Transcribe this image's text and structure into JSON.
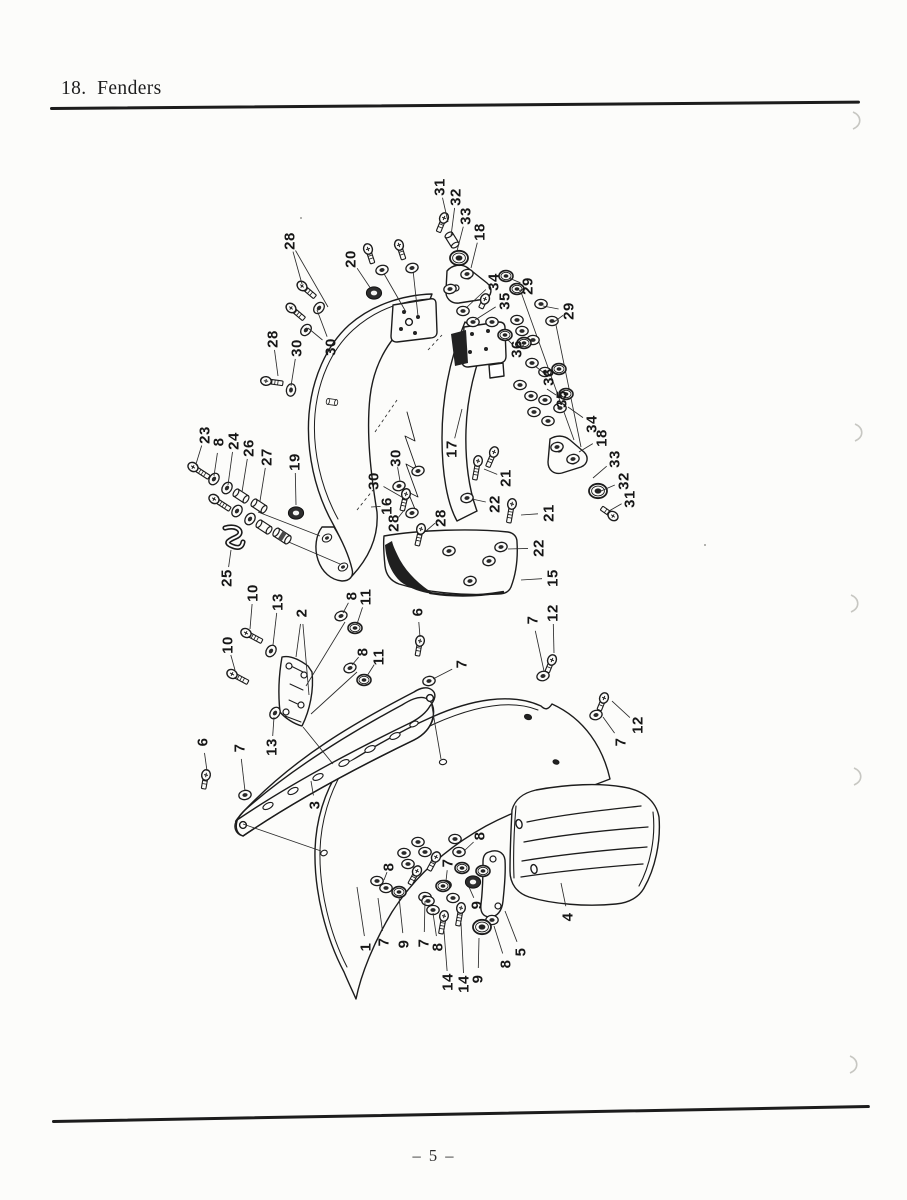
{
  "page": {
    "title": "18.  Fenders",
    "page_number": "– 5 –"
  },
  "diagram": {
    "description": "Exploded parts diagram: front and rear motorcycle fenders with numbered hardware callouts",
    "labels": [
      {
        "n": "31",
        "x": 440,
        "y": 187,
        "t": [
          448,
          222
        ]
      },
      {
        "n": "32",
        "x": 456,
        "y": 197,
        "t": [
          451,
          236
        ]
      },
      {
        "n": "33",
        "x": 466,
        "y": 216,
        "t": [
          457,
          251
        ]
      },
      {
        "n": "18",
        "x": 480,
        "y": 232,
        "t": [
          471,
          268
        ]
      },
      {
        "n": "34",
        "x": 494,
        "y": 282,
        "t": [
          466,
          308
        ]
      },
      {
        "n": "35",
        "x": 505,
        "y": 301,
        "t": [
          475,
          320
        ]
      },
      {
        "n": "29",
        "x": 528,
        "y": 286,
        "t": [
          509,
          278
        ],
        "t2": [
          519,
          291
        ]
      },
      {
        "n": "29",
        "x": 569,
        "y": 311,
        "t": [
          543,
          306
        ],
        "t2": [
          554,
          322
        ]
      },
      {
        "n": "36",
        "x": 517,
        "y": 349,
        "t": [
          506,
          338
        ],
        "t2": [
          524,
          345
        ]
      },
      {
        "n": "36",
        "x": 549,
        "y": 377,
        "t": [
          535,
          366
        ]
      },
      {
        "n": "35",
        "x": 562,
        "y": 399,
        "t": [
          547,
          389
        ]
      },
      {
        "n": "34",
        "x": 592,
        "y": 424,
        "t": [
          568,
          407
        ]
      },
      {
        "n": "18",
        "x": 602,
        "y": 438,
        "t": [
          579,
          452
        ]
      },
      {
        "n": "33",
        "x": 615,
        "y": 459,
        "t": [
          593,
          478
        ]
      },
      {
        "n": "32",
        "x": 624,
        "y": 481,
        "t": [
          601,
          491
        ]
      },
      {
        "n": "31",
        "x": 630,
        "y": 499,
        "t": [
          609,
          511
        ]
      },
      {
        "n": "28",
        "x": 290,
        "y": 241,
        "t": [
          302,
          284
        ],
        "t2": [
          328,
          307
        ]
      },
      {
        "n": "20",
        "x": 351,
        "y": 259,
        "t": [
          371,
          289
        ]
      },
      {
        "n": "28",
        "x": 273,
        "y": 339,
        "t": [
          278,
          376
        ]
      },
      {
        "n": "30",
        "x": 297,
        "y": 348,
        "t": [
          291,
          386
        ]
      },
      {
        "n": "30",
        "x": 331,
        "y": 347,
        "t": [
          317,
          310
        ],
        "t2": [
          308,
          328
        ]
      },
      {
        "n": "23",
        "x": 205,
        "y": 435,
        "t": [
          196,
          464
        ]
      },
      {
        "n": "8",
        "x": 219,
        "y": 442,
        "t": [
          214,
          476
        ]
      },
      {
        "n": "24",
        "x": 234,
        "y": 441,
        "t": [
          228,
          485
        ]
      },
      {
        "n": "26",
        "x": 249,
        "y": 448,
        "t": [
          242,
          492
        ]
      },
      {
        "n": "27",
        "x": 267,
        "y": 457,
        "t": [
          260,
          501
        ]
      },
      {
        "n": "19",
        "x": 295,
        "y": 462,
        "t": [
          296,
          505
        ]
      },
      {
        "n": "25",
        "x": 227,
        "y": 578,
        "t": [
          231,
          550
        ]
      },
      {
        "n": "17",
        "x": 452,
        "y": 449,
        "t": [
          462,
          409
        ]
      },
      {
        "n": "30",
        "x": 396,
        "y": 458,
        "t": [
          400,
          481
        ]
      },
      {
        "n": "30",
        "x": 374,
        "y": 481,
        "t": [
          407,
          500
        ]
      },
      {
        "n": "16",
        "x": 387,
        "y": 506,
        "t": [
          371,
          507
        ]
      },
      {
        "n": "28",
        "x": 394,
        "y": 523,
        "t": [
          405,
          509
        ]
      },
      {
        "n": "28",
        "x": 441,
        "y": 518,
        "t": [
          426,
          531
        ]
      },
      {
        "n": "21",
        "x": 506,
        "y": 478,
        "t": [
          484,
          469
        ]
      },
      {
        "n": "22",
        "x": 495,
        "y": 504,
        "t": [
          472,
          499
        ]
      },
      {
        "n": "21",
        "x": 549,
        "y": 513,
        "t": [
          521,
          515
        ]
      },
      {
        "n": "22",
        "x": 539,
        "y": 548,
        "t": [
          508,
          549
        ]
      },
      {
        "n": "15",
        "x": 553,
        "y": 578,
        "t": [
          521,
          580
        ]
      },
      {
        "n": "10",
        "x": 253,
        "y": 593,
        "t": [
          250,
          629
        ]
      },
      {
        "n": "13",
        "x": 278,
        "y": 602,
        "t": [
          273,
          645
        ]
      },
      {
        "n": "2",
        "x": 302,
        "y": 613,
        "t": [
          296,
          657
        ],
        "t2": [
          309,
          695
        ]
      },
      {
        "n": "8",
        "x": 352,
        "y": 596,
        "t": [
          343,
          613
        ]
      },
      {
        "n": "11",
        "x": 366,
        "y": 597,
        "t": [
          357,
          624
        ]
      },
      {
        "n": "8",
        "x": 363,
        "y": 652,
        "t": [
          352,
          665
        ]
      },
      {
        "n": "11",
        "x": 379,
        "y": 657,
        "t": [
          367,
          676
        ]
      },
      {
        "n": "10",
        "x": 228,
        "y": 645,
        "t": [
          235,
          670
        ]
      },
      {
        "n": "6",
        "x": 418,
        "y": 612,
        "t": [
          420,
          637
        ]
      },
      {
        "n": "7",
        "x": 462,
        "y": 664,
        "t": [
          433,
          679
        ]
      },
      {
        "n": "13",
        "x": 272,
        "y": 747,
        "t": [
          274,
          717
        ]
      },
      {
        "n": "6",
        "x": 203,
        "y": 742,
        "t": [
          207,
          771
        ]
      },
      {
        "n": "7",
        "x": 240,
        "y": 748,
        "t": [
          245,
          791
        ]
      },
      {
        "n": "3",
        "x": 315,
        "y": 805,
        "t": [
          311,
          781
        ]
      },
      {
        "n": "7",
        "x": 533,
        "y": 620,
        "t": [
          544,
          671
        ]
      },
      {
        "n": "12",
        "x": 553,
        "y": 613,
        "t": [
          554,
          653
        ]
      },
      {
        "n": "12",
        "x": 638,
        "y": 725,
        "t": [
          612,
          701
        ]
      },
      {
        "n": "7",
        "x": 621,
        "y": 742,
        "t": [
          603,
          717
        ]
      },
      {
        "n": "8",
        "x": 480,
        "y": 836,
        "t": [
          464,
          851
        ]
      },
      {
        "n": "7",
        "x": 448,
        "y": 863,
        "t": [
          446,
          881
        ]
      },
      {
        "n": "8",
        "x": 389,
        "y": 867,
        "t": [
          384,
          880
        ]
      },
      {
        "n": "1",
        "x": 366,
        "y": 947,
        "t": [
          357,
          887
        ]
      },
      {
        "n": "7",
        "x": 384,
        "y": 942,
        "t": [
          378,
          898
        ]
      },
      {
        "n": "9",
        "x": 404,
        "y": 944,
        "t": [
          399,
          897
        ]
      },
      {
        "n": "7",
        "x": 424,
        "y": 943,
        "t": [
          425,
          901
        ]
      },
      {
        "n": "8",
        "x": 438,
        "y": 947,
        "t": [
          433,
          913
        ]
      },
      {
        "n": "14",
        "x": 448,
        "y": 982,
        "t": [
          444,
          931
        ]
      },
      {
        "n": "14",
        "x": 464,
        "y": 984,
        "t": [
          461,
          923
        ]
      },
      {
        "n": "9",
        "x": 478,
        "y": 979,
        "t": [
          479,
          938
        ]
      },
      {
        "n": "8",
        "x": 506,
        "y": 964,
        "t": [
          494,
          926
        ]
      },
      {
        "n": "5",
        "x": 521,
        "y": 952,
        "t": [
          505,
          911
        ]
      },
      {
        "n": "9",
        "x": 477,
        "y": 905,
        "t": [
          469,
          887
        ]
      },
      {
        "n": "4",
        "x": 568,
        "y": 917,
        "t": [
          561,
          883
        ]
      }
    ],
    "fasteners": {
      "bolt": [
        [
          302,
          286,
          40,
          14
        ],
        [
          291,
          308,
          40,
          14
        ],
        [
          368,
          249,
          72,
          12
        ],
        [
          399,
          245,
          72,
          12
        ],
        [
          266,
          381,
          8,
          14
        ],
        [
          193,
          467,
          33,
          16
        ],
        [
          214,
          499,
          33,
          16
        ],
        [
          444,
          218,
          112,
          12
        ],
        [
          485,
          299,
          115,
          7
        ],
        [
          613,
          516,
          215,
          11
        ],
        [
          552,
          660,
          112,
          10
        ],
        [
          604,
          698,
          112,
          10
        ],
        [
          246,
          633,
          28,
          15
        ],
        [
          232,
          674,
          28,
          15
        ],
        [
          420,
          641,
          100,
          12
        ],
        [
          206,
          775,
          100,
          11
        ],
        [
          406,
          494,
          103,
          14
        ],
        [
          421,
          529,
          103,
          14
        ],
        [
          478,
          461,
          100,
          16
        ],
        [
          512,
          504,
          100,
          16
        ],
        [
          494,
          452,
          113,
          13
        ],
        [
          436,
          857,
          118,
          12
        ],
        [
          417,
          871,
          118,
          12
        ],
        [
          444,
          916,
          100,
          15
        ],
        [
          461,
          908,
          100,
          15
        ]
      ],
      "washer": [
        [
          319,
          308,
          -50
        ],
        [
          306,
          330,
          -50
        ],
        [
          382,
          270,
          -15
        ],
        [
          412,
          268,
          -15
        ],
        [
          291,
          390,
          -80
        ],
        [
          214,
          479,
          -55
        ],
        [
          227,
          488,
          -55
        ],
        [
          237,
          511,
          -55
        ],
        [
          250,
          519,
          -55
        ],
        [
          271,
          651,
          -55
        ],
        [
          275,
          713,
          -55
        ],
        [
          341,
          616,
          -20
        ],
        [
          350,
          668,
          -20
        ],
        [
          429,
          681,
          -10
        ],
        [
          245,
          795,
          -10
        ],
        [
          543,
          676,
          -15
        ],
        [
          596,
          715,
          -15
        ],
        [
          418,
          471,
          -15
        ],
        [
          399,
          486,
          -15
        ],
        [
          412,
          513,
          -15
        ],
        [
          467,
          498,
          -10
        ],
        [
          501,
          547,
          -10
        ],
        [
          449,
          551,
          -10
        ],
        [
          489,
          561,
          -10
        ],
        [
          470,
          581,
          -10
        ],
        [
          450,
          289,
          -10
        ],
        [
          467,
          274,
          -10
        ],
        [
          541,
          304,
          0
        ],
        [
          552,
          321,
          0
        ],
        [
          463,
          311,
          0
        ],
        [
          473,
          322,
          0
        ],
        [
          492,
          322,
          0
        ],
        [
          517,
          320,
          0
        ],
        [
          522,
          331,
          0
        ],
        [
          533,
          340,
          0
        ],
        [
          532,
          363,
          0
        ],
        [
          545,
          372,
          0
        ],
        [
          520,
          385,
          0
        ],
        [
          531,
          396,
          0
        ],
        [
          545,
          400,
          0
        ],
        [
          534,
          412,
          0
        ],
        [
          548,
          421,
          0
        ],
        [
          560,
          408,
          0
        ],
        [
          557,
          447,
          -10
        ],
        [
          573,
          459,
          -10
        ],
        [
          327,
          538,
          -30,
          0.8
        ],
        [
          343,
          567,
          -30,
          0.8
        ],
        [
          418,
          842,
          0
        ],
        [
          404,
          853,
          0
        ],
        [
          425,
          852,
          0
        ],
        [
          408,
          864,
          0
        ],
        [
          455,
          839,
          0
        ],
        [
          459,
          852,
          0
        ],
        [
          377,
          881,
          0
        ],
        [
          386,
          888,
          0
        ],
        [
          425,
          897,
          0
        ],
        [
          445,
          885,
          0
        ],
        [
          453,
          898,
          0
        ],
        [
          428,
          901,
          0
        ],
        [
          433,
          910,
          0
        ],
        [
          492,
          920,
          0
        ]
      ],
      "nut": [
        [
          506,
          276
        ],
        [
          517,
          289
        ],
        [
          505,
          335
        ],
        [
          524,
          343
        ],
        [
          559,
          369
        ],
        [
          566,
          394
        ],
        [
          355,
          628
        ],
        [
          364,
          680
        ],
        [
          462,
          868
        ],
        [
          483,
          871
        ],
        [
          399,
          892
        ],
        [
          443,
          886
        ]
      ],
      "bignut": [
        [
          459,
          258
        ],
        [
          598,
          491
        ],
        [
          482,
          927
        ]
      ],
      "spacer": [
        [
          452,
          240,
          58
        ],
        [
          241,
          496,
          33
        ],
        [
          259,
          506,
          33
        ],
        [
          264,
          527,
          33
        ],
        [
          332,
          402,
          8,
          0.7
        ]
      ],
      "spacerdark": [
        [
          282,
          536,
          33
        ]
      ],
      "grommet": [
        [
          374,
          293
        ],
        [
          296,
          513
        ],
        [
          473,
          882
        ]
      ],
      "sclip": [
        [
          232,
          540
        ]
      ]
    }
  }
}
